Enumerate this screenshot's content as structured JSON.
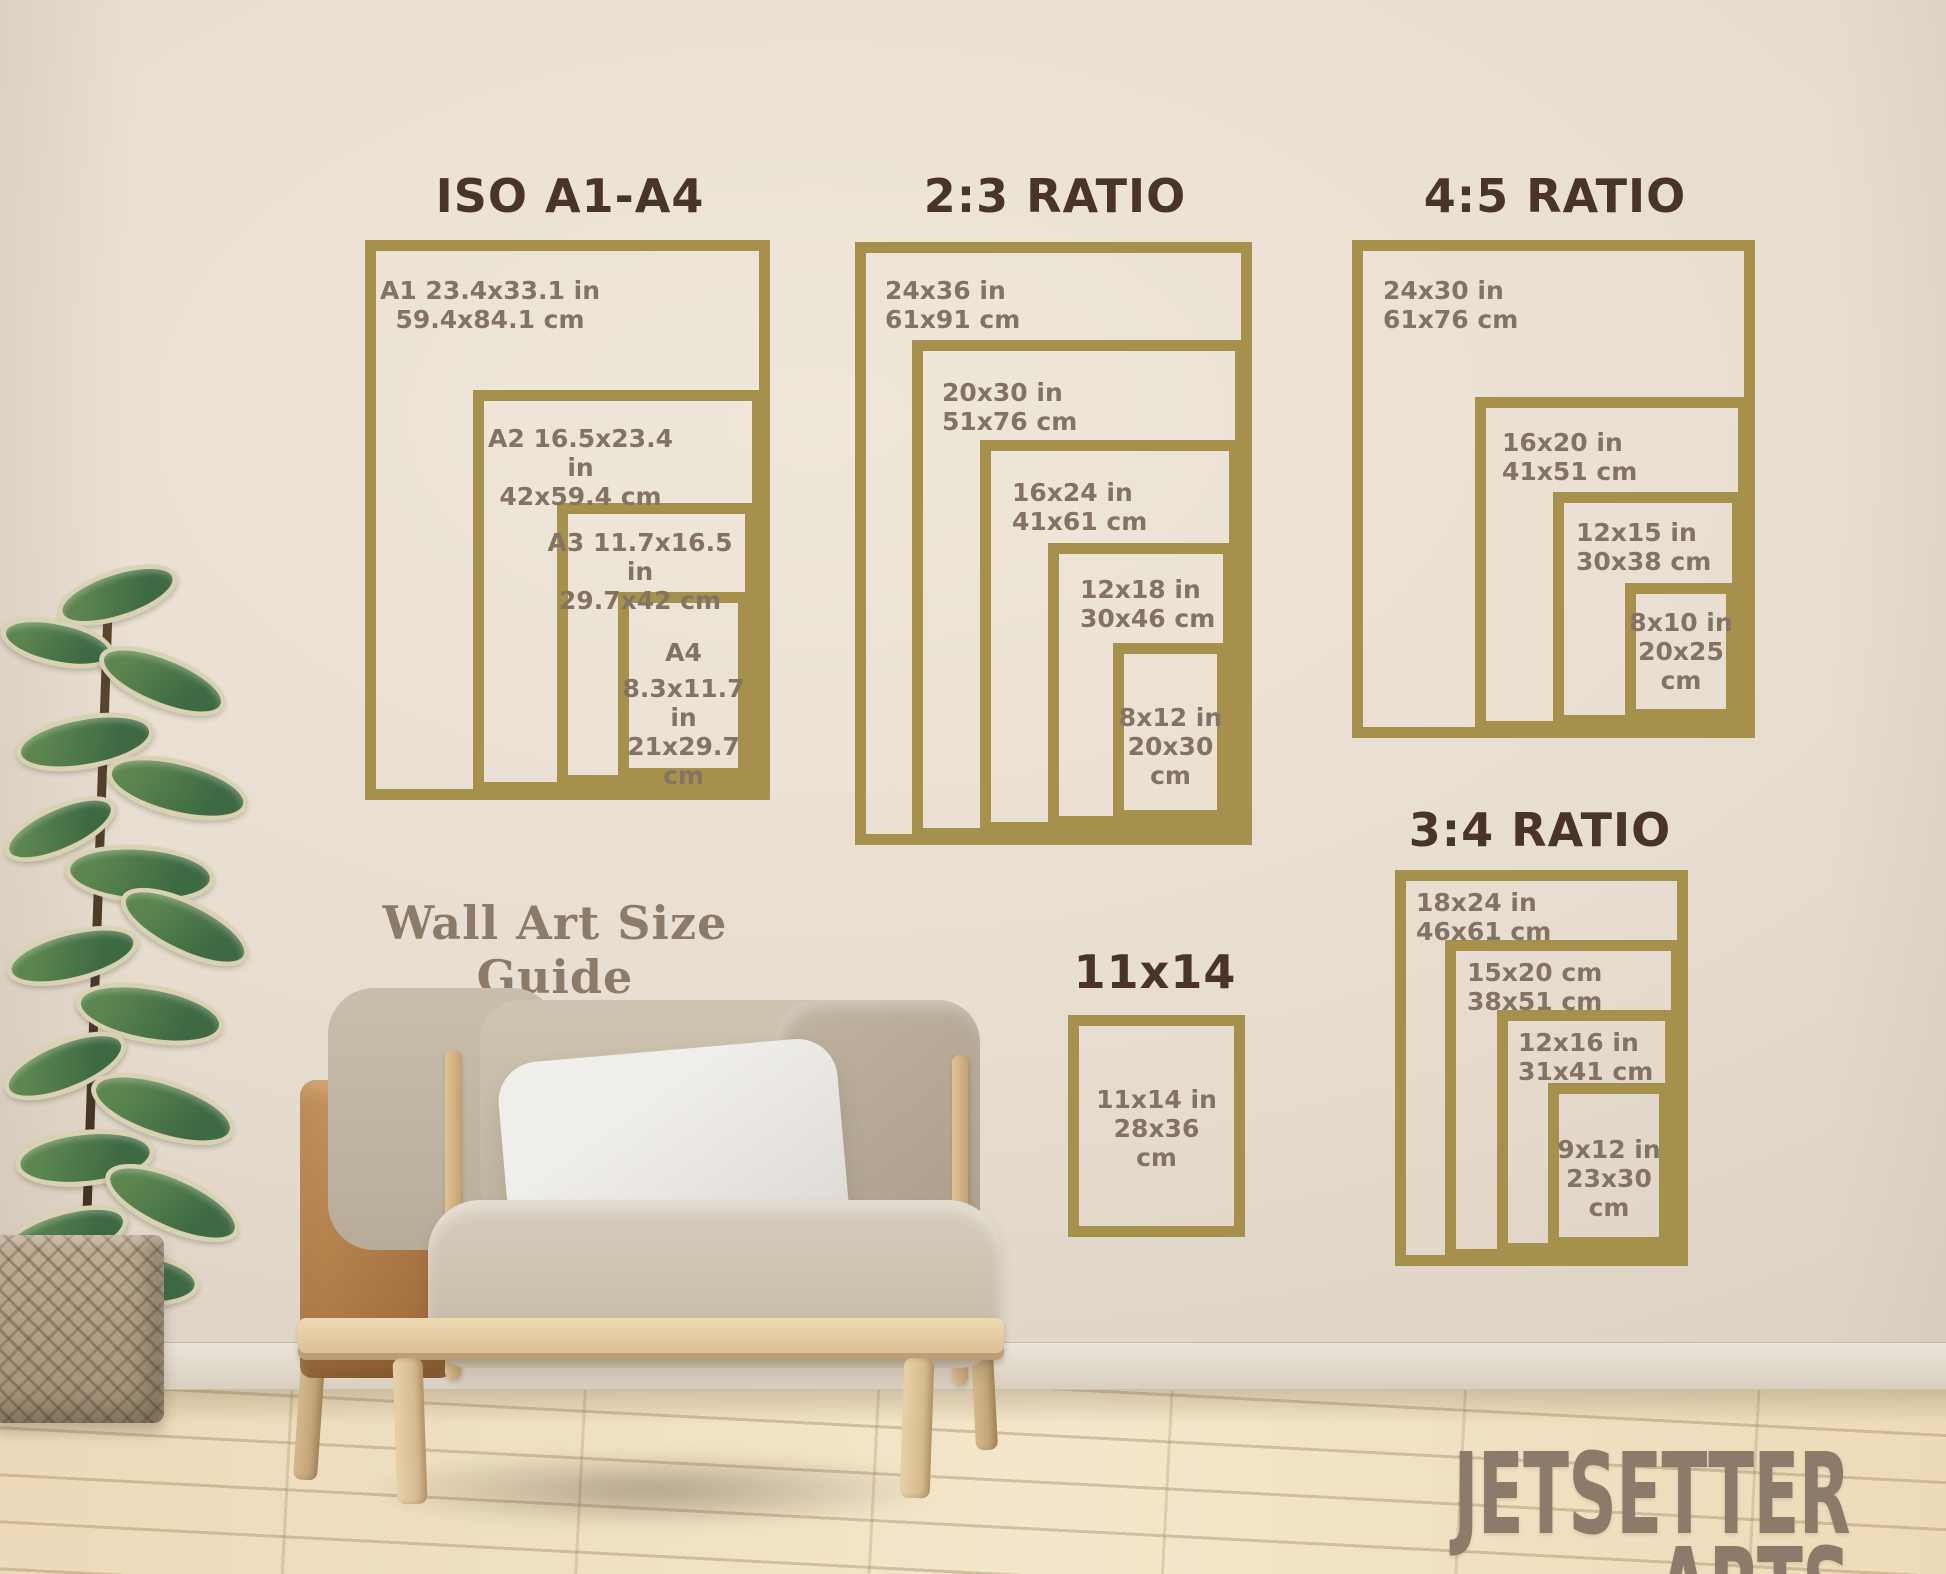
{
  "palette": {
    "gold": "#a5914c",
    "title-brown": "#4a342a",
    "label-gray": "#847362",
    "wall": "#e7ddd1",
    "caption-color": "#8d7b69",
    "brand-color": "#8c7b6a"
  },
  "caption": "Wall Art Size Guide",
  "brand": "JETSETTER ARTS",
  "sections": [
    {
      "title": "ISO A1-A4",
      "frames": [
        {
          "lines": [
            "A1 23.4x33.1 in",
            "59.4x84.1 cm"
          ]
        },
        {
          "lines": [
            "A2 16.5x23.4 in",
            "42x59.4 cm"
          ]
        },
        {
          "lines": [
            "A3 11.7x16.5 in",
            "29.7x42 cm"
          ]
        },
        {
          "lines": [
            "A4",
            "8.3x11.7 in",
            "21x29.7",
            "cm"
          ]
        }
      ]
    },
    {
      "title": "2:3 RATIO",
      "frames": [
        {
          "lines": [
            "24x36 in",
            "61x91 cm"
          ]
        },
        {
          "lines": [
            "20x30 in",
            "51x76 cm"
          ]
        },
        {
          "lines": [
            "16x24 in",
            "41x61 cm"
          ]
        },
        {
          "lines": [
            "12x18 in",
            "30x46 cm"
          ]
        },
        {
          "lines": [
            "8x12 in",
            "20x30",
            "cm"
          ]
        }
      ]
    },
    {
      "title": "4:5 RATIO",
      "frames": [
        {
          "lines": [
            "24x30 in",
            "61x76 cm"
          ]
        },
        {
          "lines": [
            "16x20 in",
            "41x51 cm"
          ]
        },
        {
          "lines": [
            "12x15 in",
            "30x38 cm"
          ]
        },
        {
          "lines": [
            "8x10 in",
            "20x25",
            "cm"
          ]
        }
      ]
    },
    {
      "title": "3:4 RATIO",
      "frames": [
        {
          "lines": [
            "18x24 in",
            "46x61 cm"
          ]
        },
        {
          "lines": [
            "15x20 cm",
            "38x51 cm"
          ]
        },
        {
          "lines": [
            "12x16 in",
            "31x41 cm"
          ]
        },
        {
          "lines": [
            "9x12 in",
            "23x30",
            "cm"
          ]
        }
      ]
    },
    {
      "title": "11x14",
      "frames": [
        {
          "lines": [
            "11x14 in",
            "28x36",
            "cm"
          ]
        }
      ]
    }
  ]
}
